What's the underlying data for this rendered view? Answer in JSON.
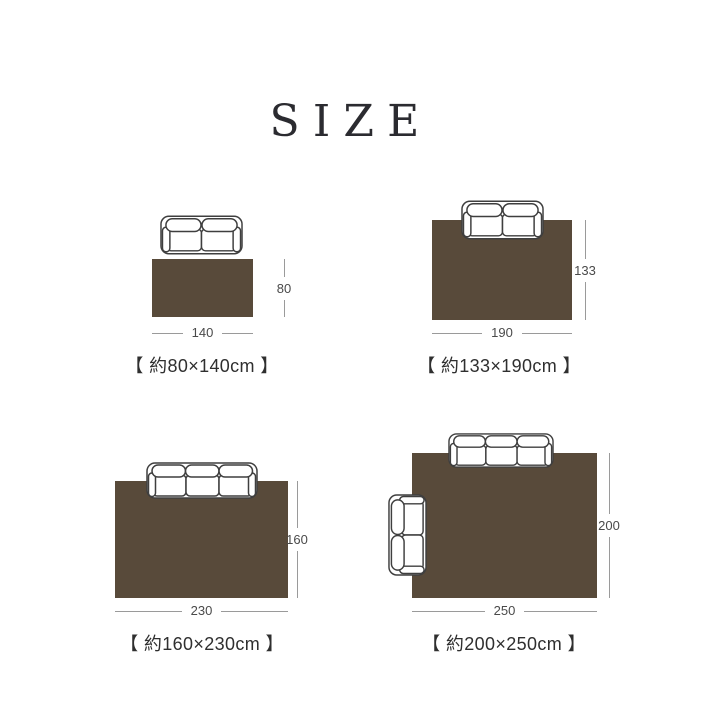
{
  "title": "SIZE",
  "colors": {
    "rug_brown": "#584a3a",
    "sofa_outline": "#3f3f3f",
    "dimension_line": "#9a9a9a",
    "dimension_text": "#4a4a4a",
    "caption_text": "#2f2f2f",
    "title_text": "#2b2b30",
    "background": "#ffffff"
  },
  "diagrams": [
    {
      "name": "80x140",
      "caption": "【 約80×140cm 】",
      "width_label": "140",
      "height_label": "80",
      "width_cm": 140,
      "height_cm": 80,
      "sofas": [
        "two-seat-sofa-top-view"
      ]
    },
    {
      "name": "133x190",
      "caption": "【 約133×190cm 】",
      "width_label": "190",
      "height_label": "133",
      "width_cm": 190,
      "height_cm": 133,
      "sofas": [
        "two-seat-sofa-top-view"
      ]
    },
    {
      "name": "160x230",
      "caption": "【 約160×230cm 】",
      "width_label": "230",
      "height_label": "160",
      "width_cm": 230,
      "height_cm": 160,
      "sofas": [
        "three-seat-sofa-top-view"
      ]
    },
    {
      "name": "200x250",
      "caption": "【 約200×250cm 】",
      "width_label": "250",
      "height_label": "200",
      "width_cm": 250,
      "height_cm": 200,
      "sofas": [
        "three-seat-sofa-top-view",
        "two-seat-sofa-side-view"
      ]
    }
  ]
}
